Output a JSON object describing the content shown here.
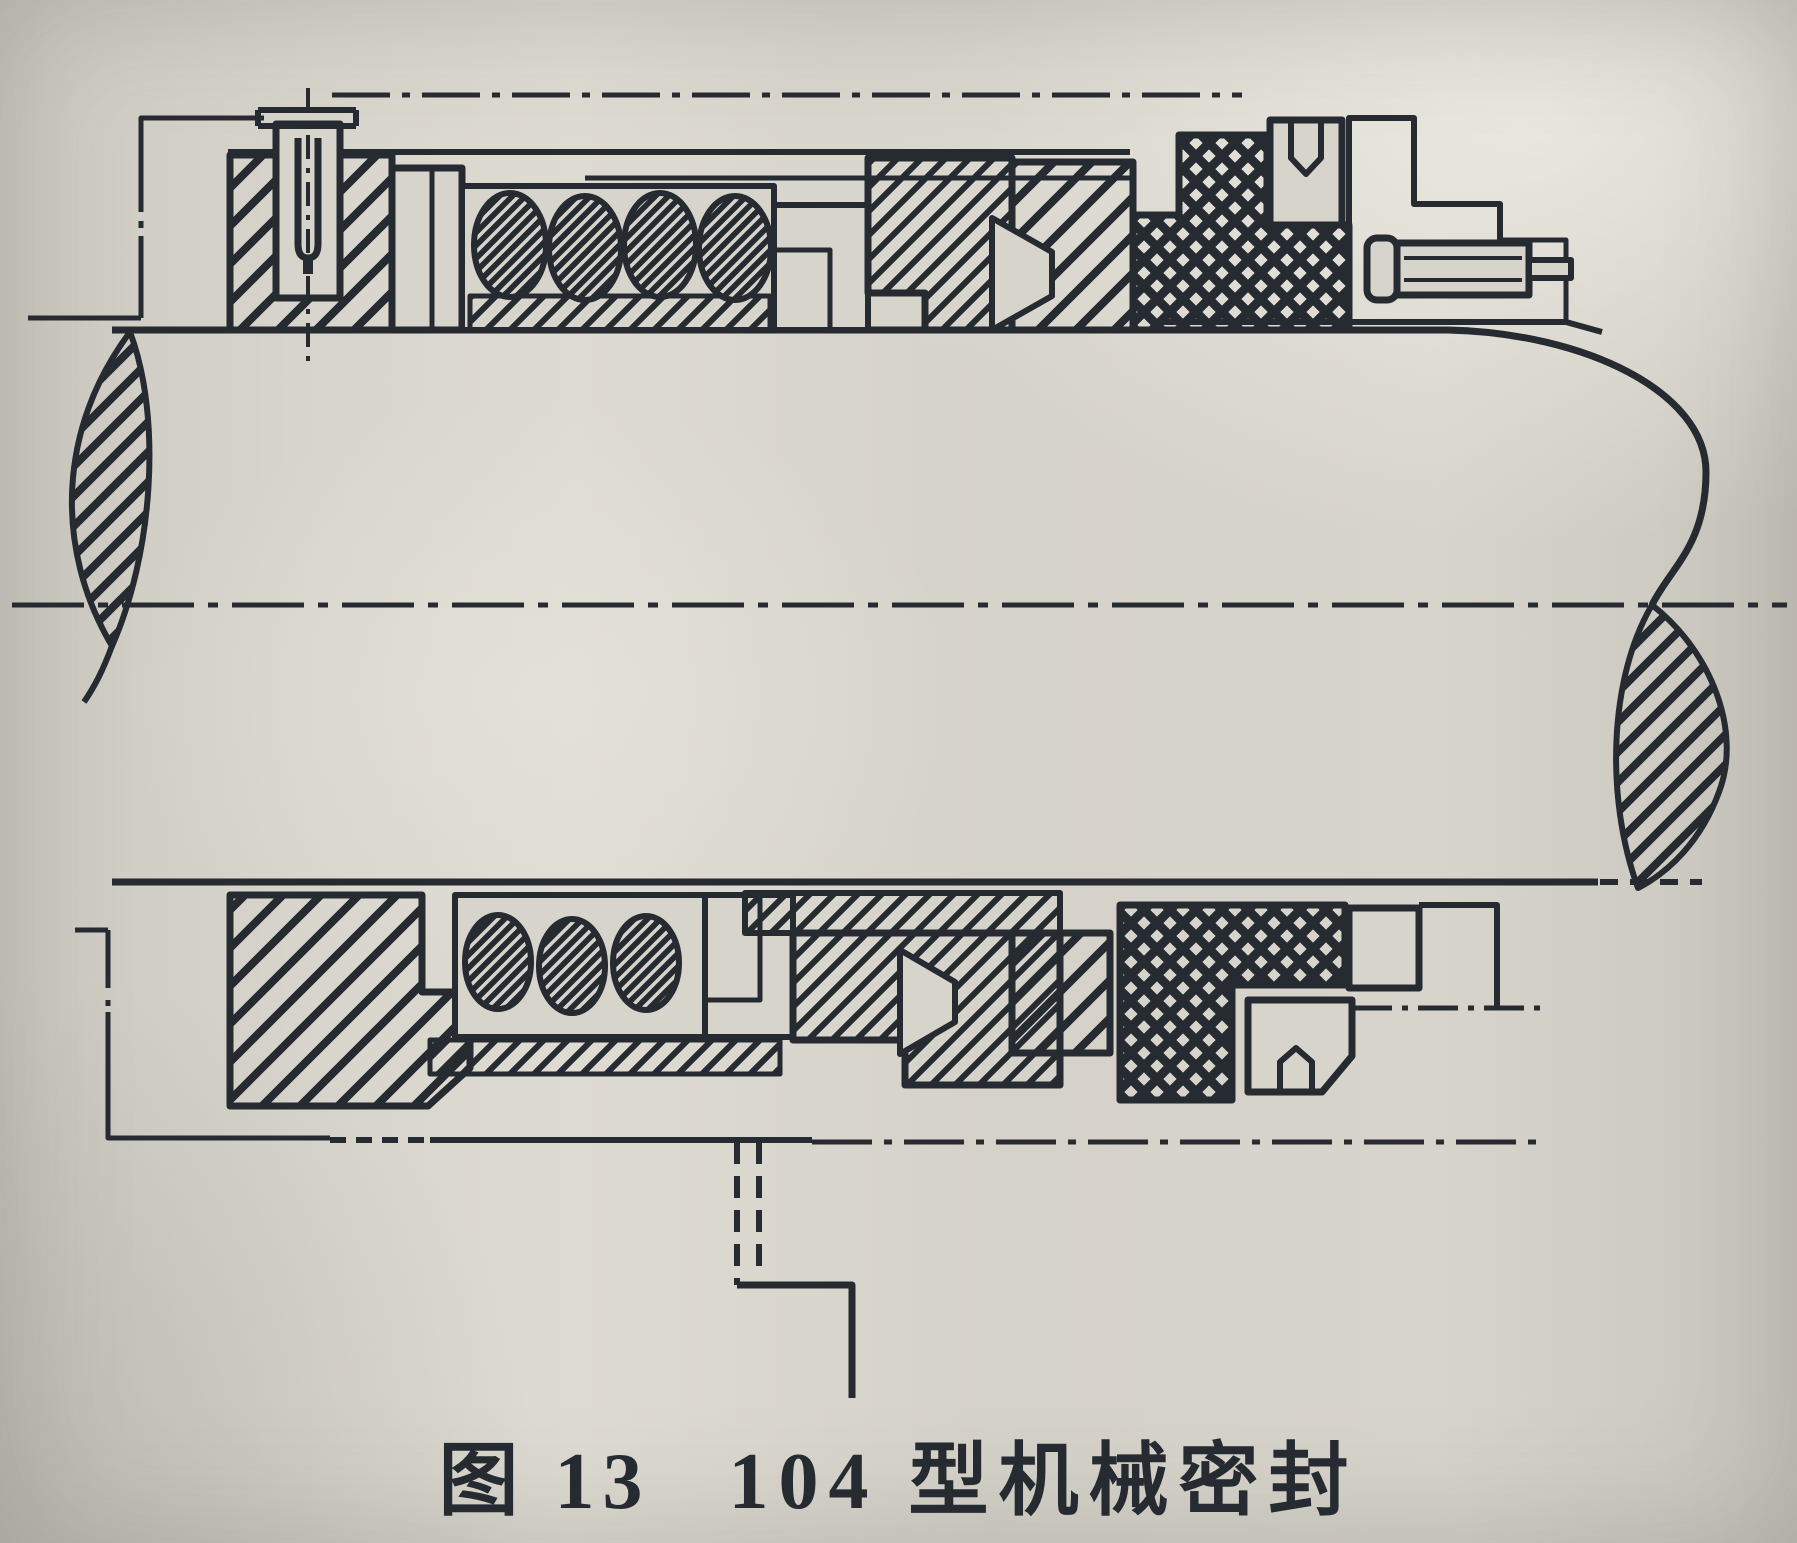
{
  "figure": {
    "number_label": "图 13",
    "title": "104 型机械密封"
  },
  "colors": {
    "ink": "#262a31",
    "paper": "#d7d4cb"
  }
}
